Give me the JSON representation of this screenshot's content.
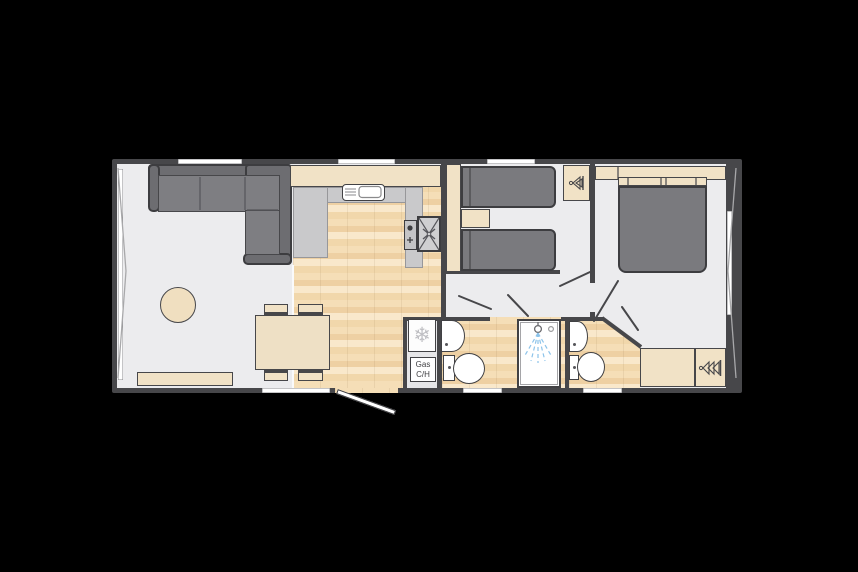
{
  "page": {
    "background": "#000000"
  },
  "plan": {
    "type": "static-caravan-floorplan",
    "labels": {
      "gas_ch": "Gas\nC/H",
      "snowflake": "❄"
    },
    "colors": {
      "wall": "#47474a",
      "floor": "#ececee",
      "wood_floor": "#f1d7ab",
      "furniture_beige": "#f1e2c6",
      "upholstery": "#7a7a7e",
      "worktop": "#c9c9cb",
      "fixture_white": "#ffffff",
      "shower_spray": "#8cc3ea",
      "window": "#ffffff"
    },
    "icons": [
      "snowflake-icon",
      "fan-oven-icon",
      "hob-burner-icon",
      "wardrobe-hangers-icon",
      "shower-head-icon"
    ],
    "rooms": [
      {
        "name": "lounge",
        "furniture": [
          "corner-sofa",
          "round-coffee-table",
          "dining-table",
          "four-dining-chairs",
          "sideboard"
        ]
      },
      {
        "name": "kitchen",
        "furniture": [
          "u-shaped-worktop",
          "sink-with-drainer",
          "oven-with-fan",
          "hob",
          "overhead-units"
        ]
      },
      {
        "name": "twin-bedroom",
        "furniture": [
          "single-bed",
          "single-bed",
          "bedside-cabinet",
          "wardrobe"
        ]
      },
      {
        "name": "shower-room",
        "furniture": [
          "washbasin",
          "toilet",
          "shower-cubicle"
        ]
      },
      {
        "name": "utility",
        "furniture": [
          "fridge",
          "gas-central-heating-unit"
        ]
      },
      {
        "name": "en-suite-wc",
        "furniture": [
          "washbasin",
          "toilet"
        ]
      },
      {
        "name": "double-bedroom",
        "furniture": [
          "double-bed",
          "overhead-lockers",
          "drawer-unit",
          "wardrobe"
        ]
      }
    ],
    "features": {
      "windows_top": 3,
      "windows_bottom": 3,
      "front_end_window": true,
      "rear_end_window": true,
      "entrance_door": "open"
    }
  }
}
